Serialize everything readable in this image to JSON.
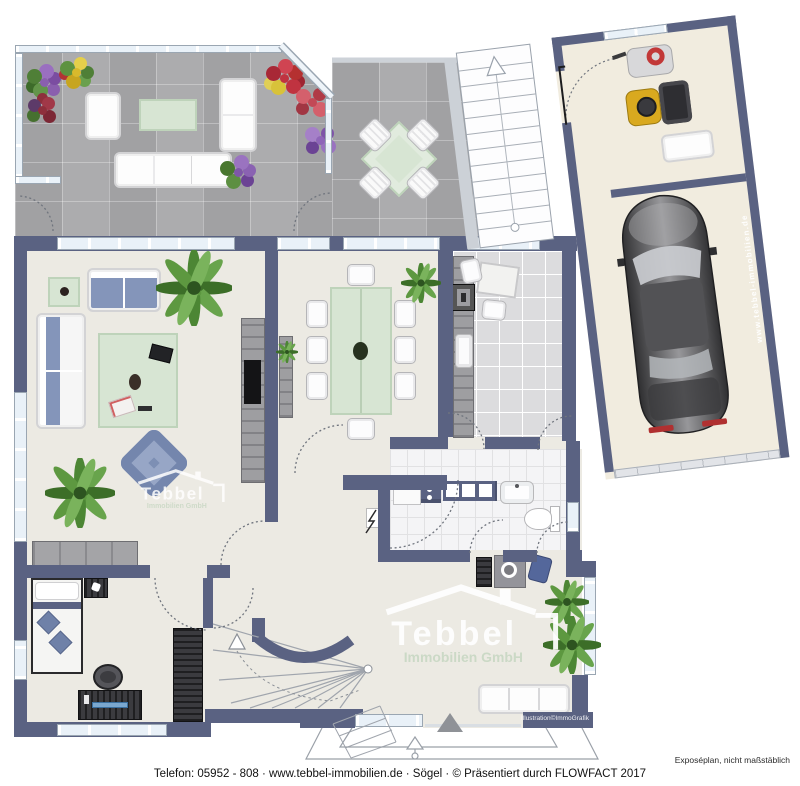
{
  "branding": {
    "logo_name": "Tebbel",
    "logo_subtitle": "Immobilien GmbH",
    "garage_wall_url": "www.tebbel-immobilien.de",
    "illustration_credit": "Illustration©ImmoGrafik"
  },
  "footer": {
    "disclaimer": "Exposéplan, nicht maßstäblich",
    "contact_line": "Telefon: 05952 - 808  ·  www.tebbel-immobilien.de  ·  Sögel  ·  © Präsentiert durch FLOWFACT 2017"
  },
  "colors": {
    "wall": "#5a6282",
    "floor": "#eceae3",
    "tile": "#a8a8aa",
    "garagefloor": "#f1ecdf",
    "ktile": "#dcdcde",
    "btile": "#f4f4f6",
    "green": "#d7e5d3",
    "blue": "#8495ba",
    "win": "#e9f1f8"
  }
}
